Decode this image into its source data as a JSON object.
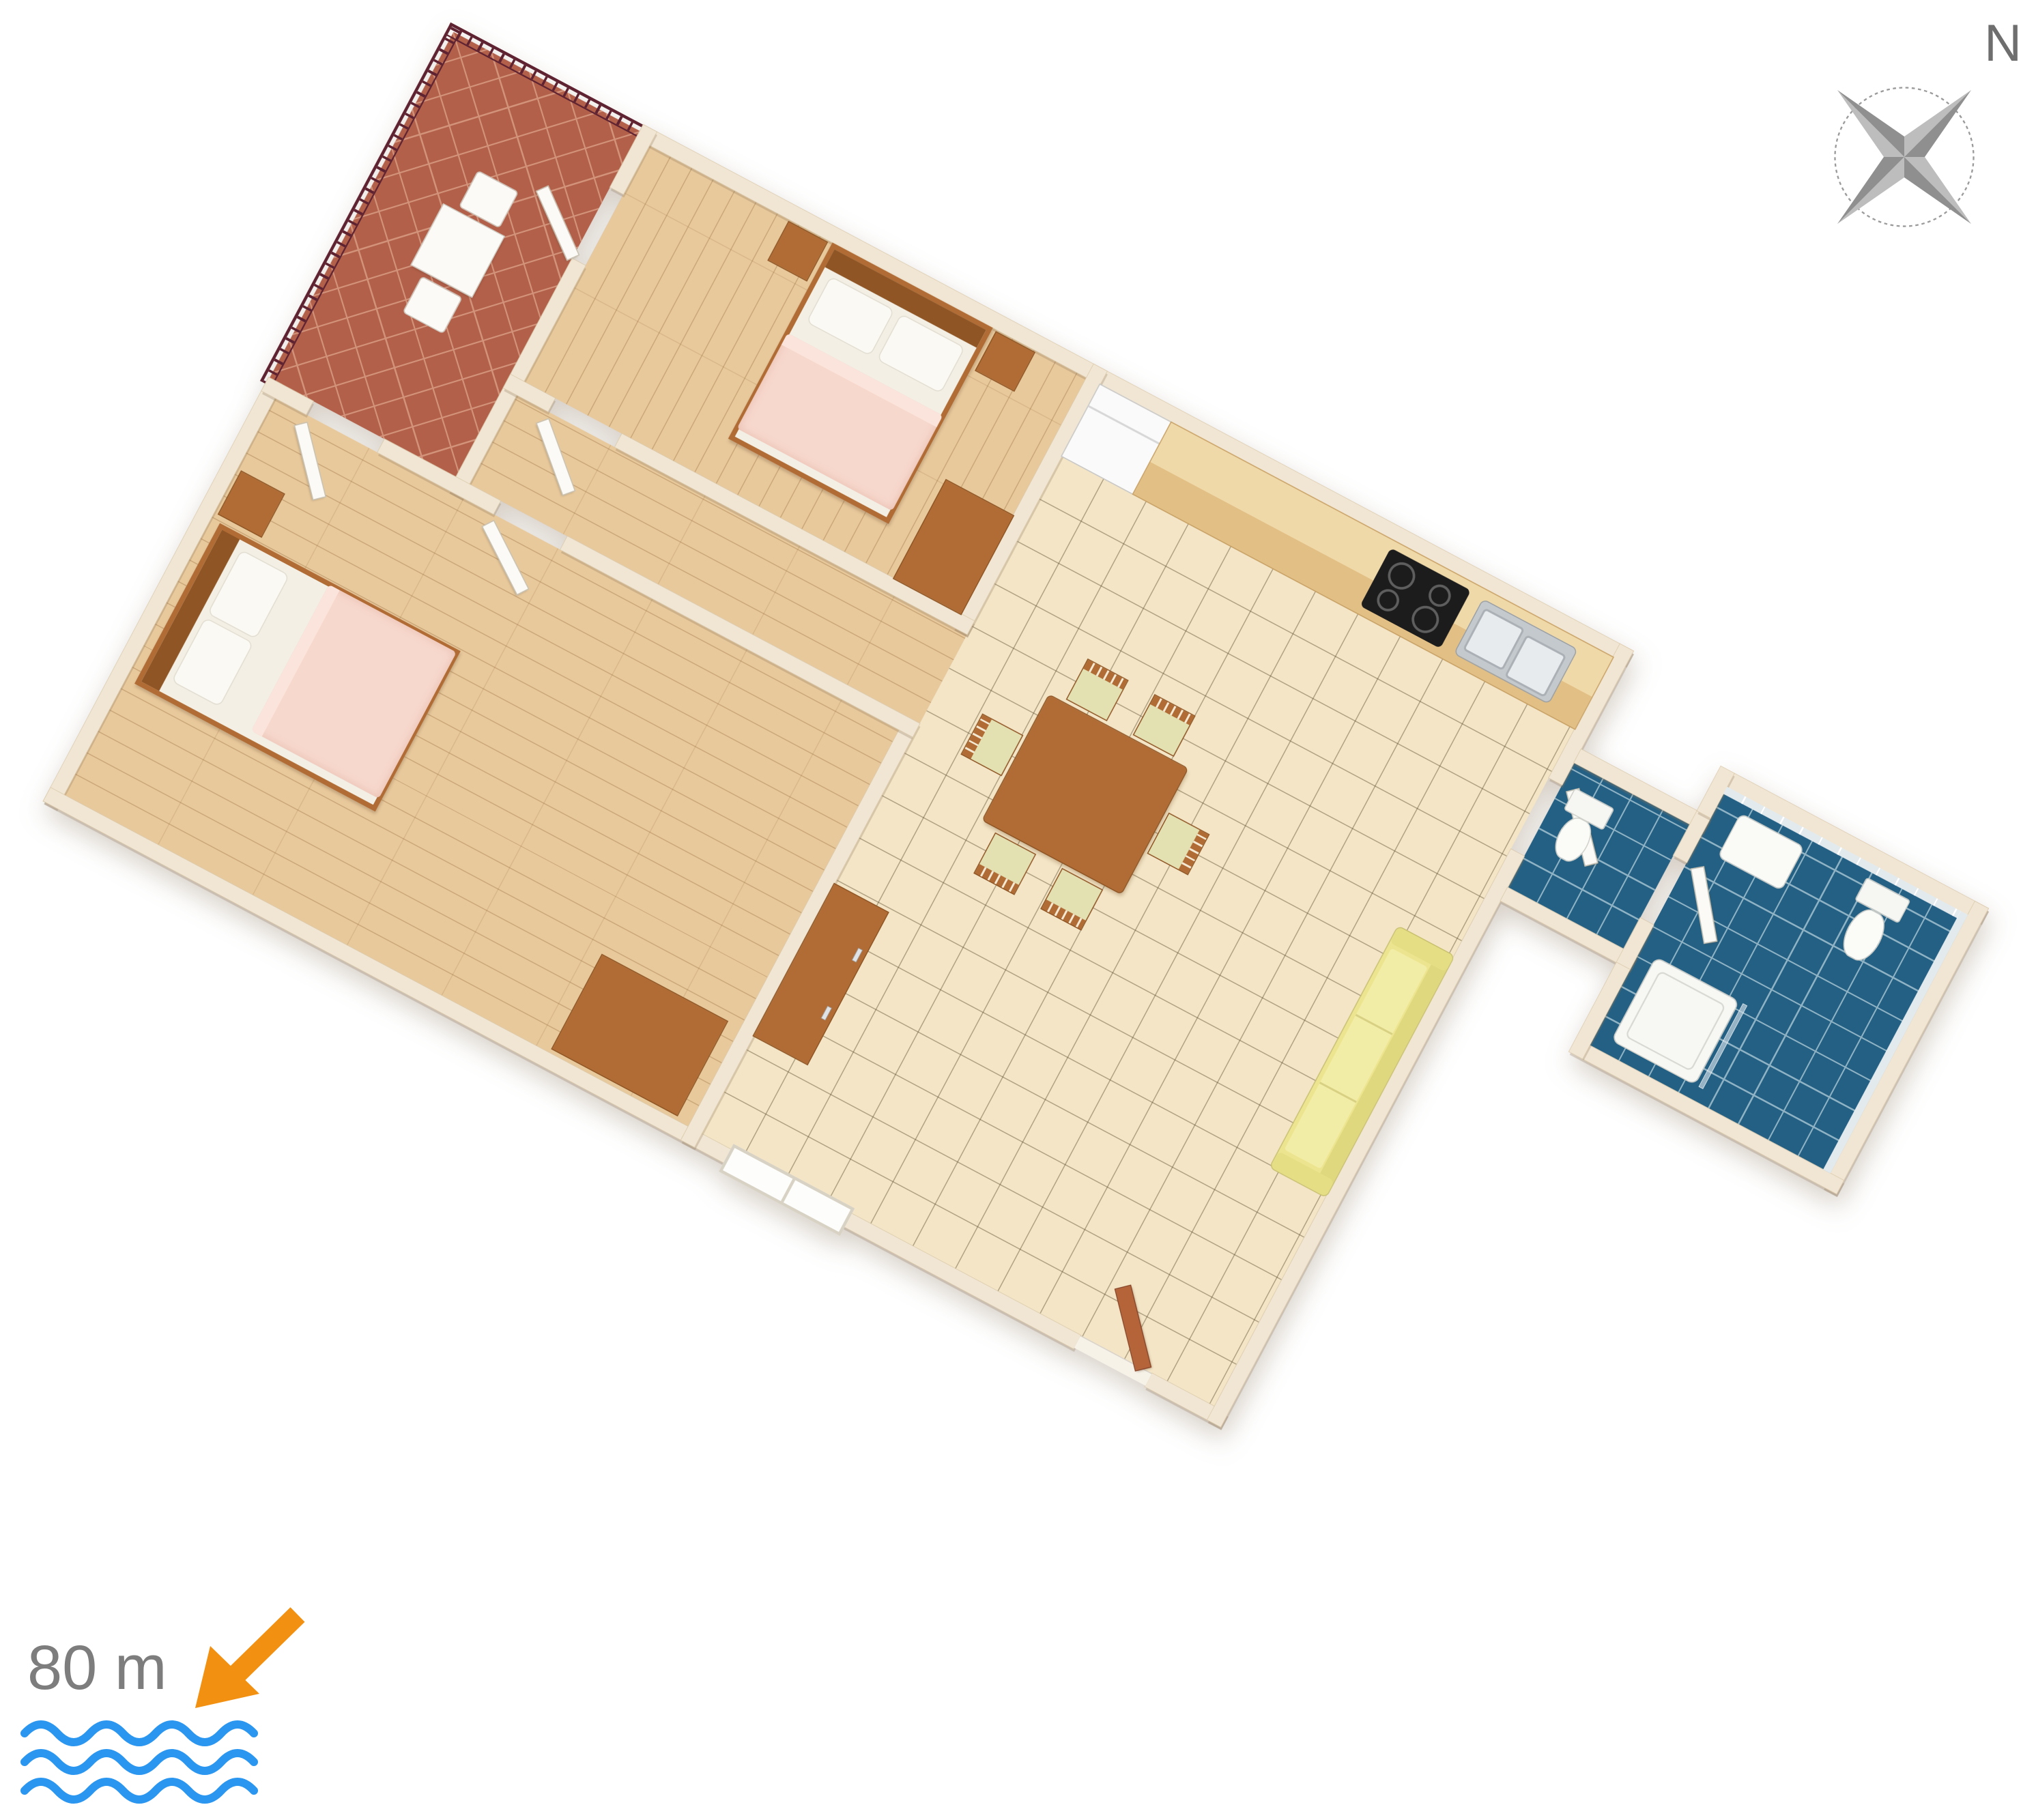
{
  "compass": {
    "north_label": "N"
  },
  "legend": {
    "distance_label": "80 m"
  },
  "colors": {
    "wall": "#f0e6d3",
    "wall_edge": "#dbc9ab",
    "terrace_tile": "#b2604a",
    "terrace_grout": "#d2937a",
    "railing": "#5e2231",
    "wood_floor": "#e8c99c",
    "living_tile": "#f3e5c6",
    "blue_tile": "#236084",
    "blue_grout": "#8fb3c4",
    "furniture_wood": "#b06c34",
    "furniture_wood_dark": "#8f5524",
    "bed_white": "#f3efe4",
    "blanket_pink": "#f7d8cd",
    "pillow": "#fbf9f3",
    "sofa_yellow": "#ece48f",
    "chair_seat": "#e3e0b2",
    "counter_top": "#f0d9a8",
    "counter_front": "#e2bf85",
    "fridge": "#fafafa",
    "cooktop": "#1c1c1c",
    "sink_steel": "#c4c9cd",
    "door_white": "#fbfaf6",
    "door_brown": "#b5643a",
    "compass_gray": "#a0a0a0",
    "text_gray": "#7d7d7d",
    "arrow_orange": "#f29111",
    "wave_blue": "#2b96f0"
  }
}
